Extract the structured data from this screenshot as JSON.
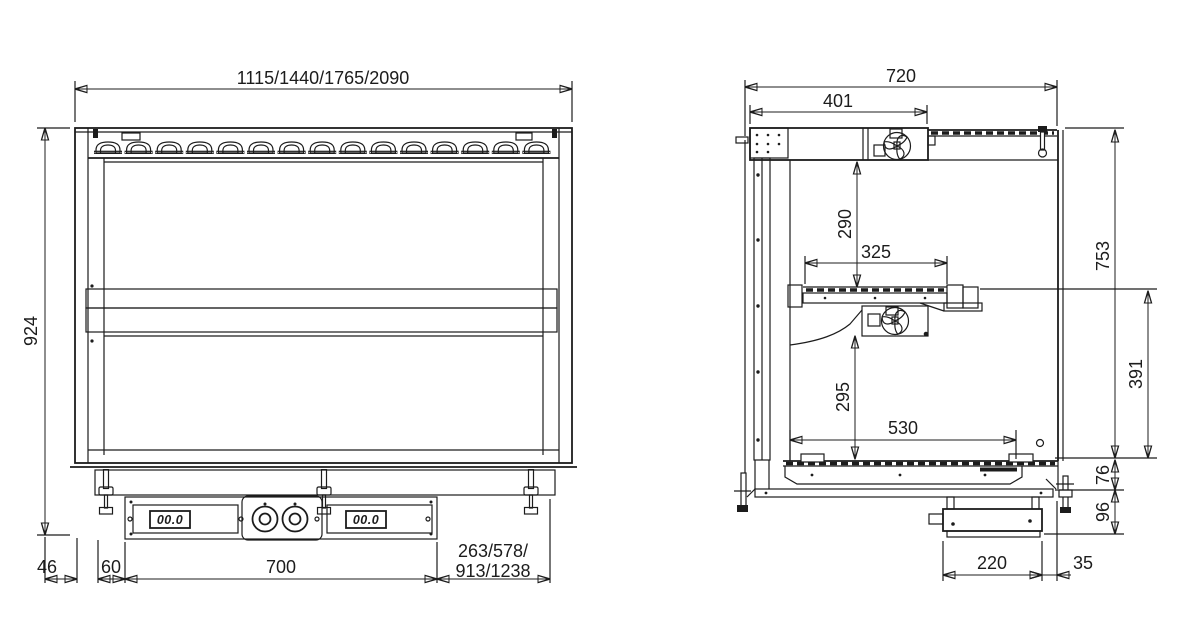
{
  "front_view": {
    "dims": {
      "overall_width": "1115/1440/1765/2090",
      "overall_height": "924",
      "side_offset": "46",
      "edge_inset": "60",
      "control_panel_width": "700",
      "cutout_offset_line1": "263/578/",
      "cutout_offset_line2": "913/1238"
    },
    "control_panel": {
      "left_display_value": "00.0",
      "right_display_value": "00.0"
    }
  },
  "side_view": {
    "dims": {
      "overall_depth": "720",
      "canopy_depth": "401",
      "canopy_to_shelf": "290",
      "shelf_depth": "325",
      "interior_height": "753",
      "shelf_to_well": "391",
      "clearance_under_shelf": "295",
      "well_depth": "530",
      "base_height": "76",
      "junction_box_height": "96",
      "junction_box_depth": "220",
      "junction_box_offset": "35"
    }
  }
}
